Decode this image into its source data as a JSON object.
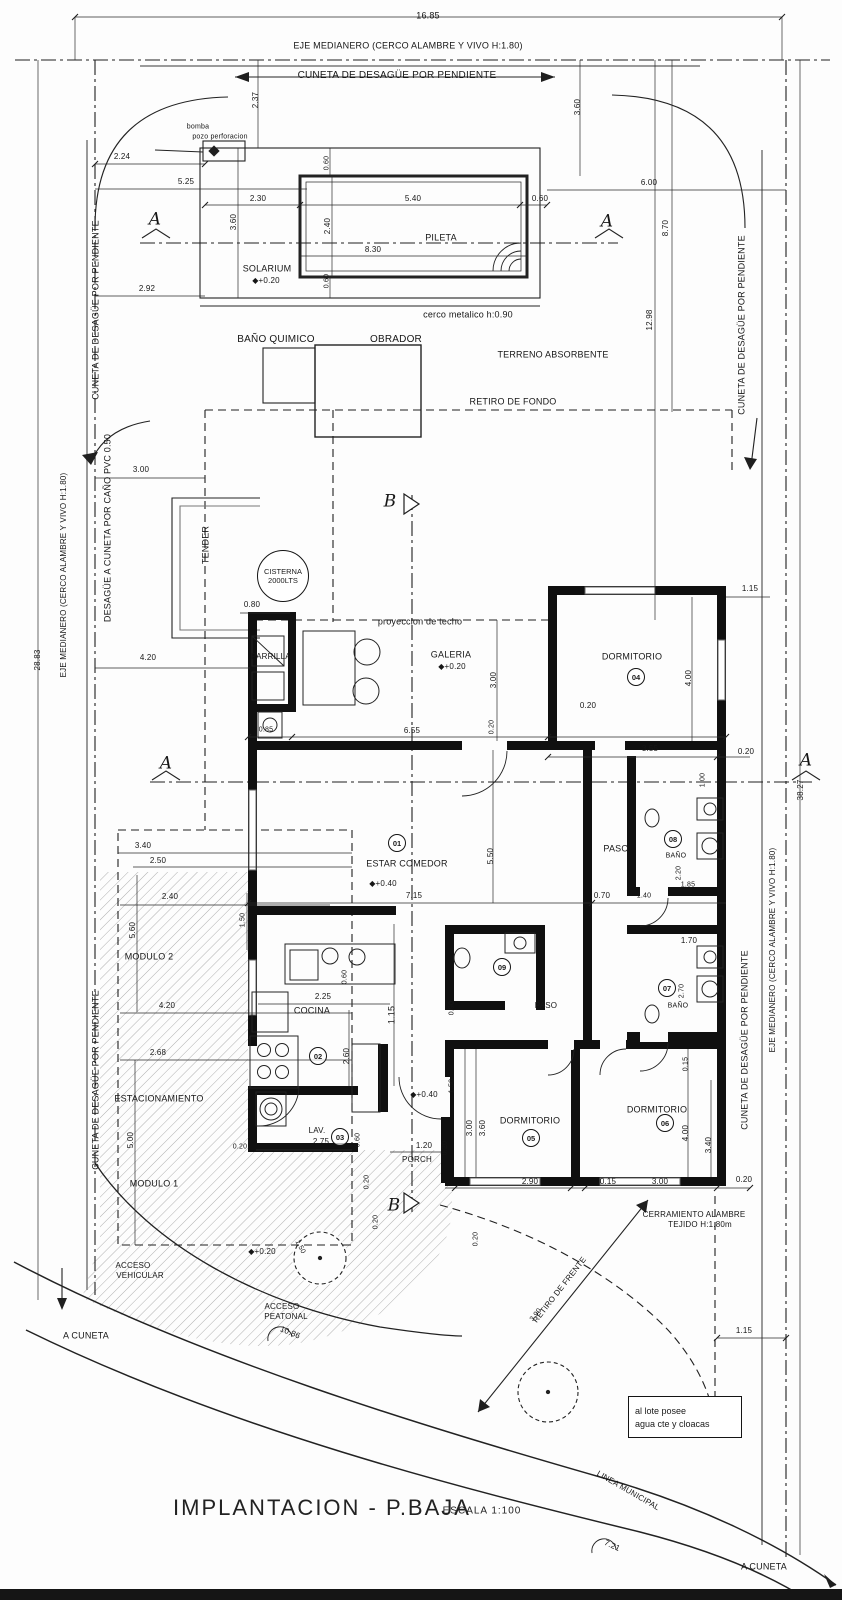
{
  "meta": {
    "title_main": "IMPLANTACION  -  P.BAJA",
    "title_scale": "ESCALA 1:100",
    "ink": "#1a1a1a",
    "wall": "#101010",
    "gray": "#9a9a9a"
  },
  "cisterna": {
    "l1": "CISTERNA",
    "l2": "2000LTS"
  },
  "note_box": {
    "l1": "al lote posee",
    "l2": "agua cte y cloacas"
  },
  "room_numbers": [
    {
      "n": "01",
      "x": 397,
      "y": 843
    },
    {
      "n": "02",
      "x": 318,
      "y": 1056
    },
    {
      "n": "03",
      "x": 340,
      "y": 1137
    },
    {
      "n": "04",
      "x": 636,
      "y": 677
    },
    {
      "n": "05",
      "x": 531,
      "y": 1138
    },
    {
      "n": "06",
      "x": 665,
      "y": 1123
    },
    {
      "n": "07",
      "x": 667,
      "y": 988
    },
    {
      "n": "08",
      "x": 673,
      "y": 839
    },
    {
      "n": "09",
      "x": 502,
      "y": 967
    }
  ],
  "labels": [
    {
      "t": "16.85",
      "x": 428,
      "y": 16,
      "r": 0,
      "s": 9
    },
    {
      "t": "EJE MEDIANERO (CERCO ALAMBRE Y VIVO H:1.80)",
      "x": 408,
      "y": 46,
      "r": 0,
      "s": 9
    },
    {
      "t": "CUNETA DE DESAGÜE POR PENDIENTE",
      "x": 397,
      "y": 76,
      "r": 0,
      "s": 10
    },
    {
      "t": "2.37",
      "x": 256,
      "y": 100,
      "r": -90,
      "s": 8
    },
    {
      "t": "3.60",
      "x": 578,
      "y": 107,
      "r": -90,
      "s": 8
    },
    {
      "t": "bomba",
      "x": 198,
      "y": 127,
      "r": 0,
      "s": 7
    },
    {
      "t": "pozo perforacion",
      "x": 220,
      "y": 137,
      "r": 0,
      "s": 7
    },
    {
      "t": "2.24",
      "x": 122,
      "y": 157,
      "r": 0,
      "s": 8
    },
    {
      "t": "5.25",
      "x": 186,
      "y": 182,
      "r": 0,
      "s": 8
    },
    {
      "t": "0.60",
      "x": 327,
      "y": 163,
      "r": -90,
      "s": 7
    },
    {
      "t": "2.30",
      "x": 258,
      "y": 199,
      "r": 0,
      "s": 8
    },
    {
      "t": "5.40",
      "x": 413,
      "y": 199,
      "r": 0,
      "s": 8
    },
    {
      "t": "0.60",
      "x": 540,
      "y": 199,
      "r": 0,
      "s": 8
    },
    {
      "t": "3.60",
      "x": 234,
      "y": 222,
      "r": -90,
      "s": 8
    },
    {
      "t": "2.40",
      "x": 328,
      "y": 226,
      "r": -90,
      "s": 8
    },
    {
      "t": "A",
      "x": 155,
      "y": 220,
      "r": 0,
      "s": 17,
      "i": 1
    },
    {
      "t": "A",
      "x": 607,
      "y": 222,
      "r": 0,
      "s": 17,
      "i": 1
    },
    {
      "t": "PILETA",
      "x": 441,
      "y": 238,
      "r": 0,
      "s": 9
    },
    {
      "t": "8.30",
      "x": 373,
      "y": 250,
      "r": 0,
      "s": 8
    },
    {
      "t": "SOLARIUM",
      "x": 267,
      "y": 269,
      "r": 0,
      "s": 9
    },
    {
      "t": "◆+0.20",
      "x": 266,
      "y": 281,
      "r": 0,
      "s": 8
    },
    {
      "t": "2.92",
      "x": 147,
      "y": 289,
      "r": 0,
      "s": 8
    },
    {
      "t": "0.60",
      "x": 327,
      "y": 281,
      "r": -90,
      "s": 7
    },
    {
      "t": "6.00",
      "x": 649,
      "y": 183,
      "r": 0,
      "s": 8
    },
    {
      "t": "8.70",
      "x": 666,
      "y": 228,
      "r": -90,
      "s": 8
    },
    {
      "t": "12.98",
      "x": 650,
      "y": 320,
      "r": -90,
      "s": 8
    },
    {
      "t": "cerco metalico h:0.90",
      "x": 468,
      "y": 315,
      "r": 0,
      "s": 9
    },
    {
      "t": "BAÑO QUIMICO",
      "x": 276,
      "y": 340,
      "r": 0,
      "s": 10
    },
    {
      "t": "OBRADOR",
      "x": 396,
      "y": 340,
      "r": 0,
      "s": 10
    },
    {
      "t": "TERRENO ABSORBENTE",
      "x": 553,
      "y": 355,
      "r": 0,
      "s": 9
    },
    {
      "t": "RETIRO DE FONDO",
      "x": 513,
      "y": 402,
      "r": 0,
      "s": 9
    },
    {
      "t": "CUNETA DE DESAGÜE POR PENDIENTE",
      "x": 742,
      "y": 325,
      "r": -90,
      "s": 9
    },
    {
      "t": "CUNETA DE DESAGÜE POR PENDIENTE",
      "x": 96,
      "y": 310,
      "r": -90,
      "s": 9
    },
    {
      "t": "3.00",
      "x": 141,
      "y": 470,
      "r": 0,
      "s": 8
    },
    {
      "t": "DESAGÜE A CUNETA POR CAÑO PVC 0.50",
      "x": 108,
      "y": 528,
      "r": -90,
      "s": 9
    },
    {
      "t": "EJE MEDIANERO (CERCO ALAMBRE Y VIVO H:1.80)",
      "x": 64,
      "y": 575,
      "r": -90,
      "s": 8
    },
    {
      "t": "28.83",
      "x": 38,
      "y": 660,
      "r": -90,
      "s": 8
    },
    {
      "t": "TENDER",
      "x": 206,
      "y": 545,
      "r": -90,
      "s": 9
    },
    {
      "t": "B",
      "x": 390,
      "y": 502,
      "r": 0,
      "s": 17,
      "i": 1
    },
    {
      "t": "0.80",
      "x": 252,
      "y": 605,
      "r": 0,
      "s": 8
    },
    {
      "t": "proyeccion de techo",
      "x": 420,
      "y": 622,
      "r": 0,
      "s": 9
    },
    {
      "t": "PARRILLA",
      "x": 271,
      "y": 657,
      "r": 0,
      "s": 8
    },
    {
      "t": "GALERIA",
      "x": 451,
      "y": 655,
      "r": 0,
      "s": 9
    },
    {
      "t": "◆+0.20",
      "x": 452,
      "y": 667,
      "r": 0,
      "s": 8
    },
    {
      "t": "3.00",
      "x": 494,
      "y": 680,
      "r": -90,
      "s": 8
    },
    {
      "t": "4.20",
      "x": 148,
      "y": 658,
      "r": 0,
      "s": 8
    },
    {
      "t": "DORMITORIO",
      "x": 632,
      "y": 657,
      "r": 0,
      "s": 9
    },
    {
      "t": "1.15",
      "x": 750,
      "y": 589,
      "r": 0,
      "s": 8
    },
    {
      "t": "4.00",
      "x": 689,
      "y": 678,
      "r": -90,
      "s": 8
    },
    {
      "t": "0.20",
      "x": 588,
      "y": 706,
      "r": 0,
      "s": 8
    },
    {
      "t": "0.85",
      "x": 266,
      "y": 730,
      "r": 0,
      "s": 7
    },
    {
      "t": "6.55",
      "x": 412,
      "y": 731,
      "r": 0,
      "s": 8
    },
    {
      "t": "0.20",
      "x": 492,
      "y": 727,
      "r": -90,
      "s": 7
    },
    {
      "t": "3.55",
      "x": 650,
      "y": 749,
      "r": 0,
      "s": 8
    },
    {
      "t": "0.20",
      "x": 746,
      "y": 752,
      "r": 0,
      "s": 8
    },
    {
      "t": "A",
      "x": 166,
      "y": 764,
      "r": 0,
      "s": 17,
      "i": 1
    },
    {
      "t": "A",
      "x": 806,
      "y": 761,
      "r": 0,
      "s": 17,
      "i": 1
    },
    {
      "t": "38.27",
      "x": 801,
      "y": 790,
      "r": -90,
      "s": 8
    },
    {
      "t": "3.40",
      "x": 143,
      "y": 846,
      "r": 0,
      "s": 8
    },
    {
      "t": "2.50",
      "x": 158,
      "y": 861,
      "r": 0,
      "s": 8
    },
    {
      "t": "2.40",
      "x": 170,
      "y": 897,
      "r": 0,
      "s": 8
    },
    {
      "t": "5.60",
      "x": 133,
      "y": 930,
      "r": -90,
      "s": 8
    },
    {
      "t": "1.50",
      "x": 243,
      "y": 920,
      "r": -90,
      "s": 7
    },
    {
      "t": "MODULO 2",
      "x": 149,
      "y": 957,
      "r": 0,
      "s": 9
    },
    {
      "t": "ESTAR COMEDOR",
      "x": 407,
      "y": 864,
      "r": 0,
      "s": 9
    },
    {
      "t": "◆+0.40",
      "x": 383,
      "y": 884,
      "r": 0,
      "s": 8
    },
    {
      "t": "5.50",
      "x": 491,
      "y": 856,
      "r": -90,
      "s": 8
    },
    {
      "t": "7.15",
      "x": 414,
      "y": 896,
      "r": 0,
      "s": 8
    },
    {
      "t": "PASO",
      "x": 616,
      "y": 849,
      "r": 0,
      "s": 9
    },
    {
      "t": "0.70",
      "x": 602,
      "y": 896,
      "r": 0,
      "s": 8
    },
    {
      "t": "1.40",
      "x": 644,
      "y": 896,
      "r": 0,
      "s": 7
    },
    {
      "t": "BAÑO",
      "x": 676,
      "y": 856,
      "r": 0,
      "s": 7
    },
    {
      "t": "2.20",
      "x": 679,
      "y": 873,
      "r": -90,
      "s": 7
    },
    {
      "t": "1.00",
      "x": 703,
      "y": 780,
      "r": -90,
      "s": 7
    },
    {
      "t": "1.85",
      "x": 688,
      "y": 885,
      "r": 0,
      "s": 7
    },
    {
      "t": "1.70",
      "x": 689,
      "y": 941,
      "r": 0,
      "s": 8
    },
    {
      "t": "2.70",
      "x": 682,
      "y": 991,
      "r": -90,
      "s": 7
    },
    {
      "t": "BAÑO",
      "x": 678,
      "y": 1006,
      "r": 0,
      "s": 7
    },
    {
      "t": "0.90",
      "x": 452,
      "y": 1008,
      "r": -90,
      "s": 7
    },
    {
      "t": "PASO",
      "x": 546,
      "y": 1006,
      "r": 0,
      "s": 8
    },
    {
      "t": "COCINA",
      "x": 312,
      "y": 1011,
      "r": 0,
      "s": 9
    },
    {
      "t": "2.25",
      "x": 323,
      "y": 997,
      "r": 0,
      "s": 8
    },
    {
      "t": "0.60",
      "x": 345,
      "y": 977,
      "r": -90,
      "s": 7
    },
    {
      "t": "1.15",
      "x": 392,
      "y": 1015,
      "r": -90,
      "s": 9
    },
    {
      "t": "2.60",
      "x": 347,
      "y": 1056,
      "r": -90,
      "s": 8
    },
    {
      "t": "ESTACIONAMIENTO",
      "x": 159,
      "y": 1099,
      "r": 0,
      "s": 9
    },
    {
      "t": "5.00",
      "x": 131,
      "y": 1140,
      "r": -90,
      "s": 8
    },
    {
      "t": "MODULO 1",
      "x": 154,
      "y": 1184,
      "r": 0,
      "s": 9
    },
    {
      "t": "4.20",
      "x": 167,
      "y": 1006,
      "r": 0,
      "s": 8
    },
    {
      "t": "2.68",
      "x": 158,
      "y": 1053,
      "r": 0,
      "s": 8
    },
    {
      "t": "◆+0.40",
      "x": 424,
      "y": 1095,
      "r": 0,
      "s": 8
    },
    {
      "t": "1.50",
      "x": 452,
      "y": 1086,
      "r": -90,
      "s": 7
    },
    {
      "t": "LAV.",
      "x": 317,
      "y": 1131,
      "r": 0,
      "s": 8
    },
    {
      "t": "2.75",
      "x": 321,
      "y": 1142,
      "r": 0,
      "s": 8
    },
    {
      "t": "0.60",
      "x": 358,
      "y": 1140,
      "r": -90,
      "s": 7
    },
    {
      "t": "0.20",
      "x": 240,
      "y": 1147,
      "r": 0,
      "s": 7
    },
    {
      "t": "1.20",
      "x": 424,
      "y": 1146,
      "r": 0,
      "s": 8
    },
    {
      "t": "PORCH",
      "x": 417,
      "y": 1160,
      "r": 0,
      "s": 8
    },
    {
      "t": "0.20",
      "x": 445,
      "y": 1148,
      "r": -90,
      "s": 7
    },
    {
      "t": "0.20",
      "x": 367,
      "y": 1182,
      "r": -90,
      "s": 7
    },
    {
      "t": "DORMITORIO",
      "x": 530,
      "y": 1121,
      "r": 0,
      "s": 9
    },
    {
      "t": "3.60",
      "x": 483,
      "y": 1128,
      "r": -90,
      "s": 8
    },
    {
      "t": "3.00",
      "x": 470,
      "y": 1128,
      "r": -90,
      "s": 8
    },
    {
      "t": "DORMITORIO",
      "x": 657,
      "y": 1110,
      "r": 0,
      "s": 9
    },
    {
      "t": "4.00",
      "x": 686,
      "y": 1133,
      "r": -90,
      "s": 8
    },
    {
      "t": "3.40",
      "x": 709,
      "y": 1145,
      "r": -90,
      "s": 8
    },
    {
      "t": "0.15",
      "x": 686,
      "y": 1064,
      "r": -90,
      "s": 7
    },
    {
      "t": "2.90",
      "x": 530,
      "y": 1182,
      "r": 0,
      "s": 8
    },
    {
      "t": "0.15",
      "x": 608,
      "y": 1182,
      "r": 0,
      "s": 8
    },
    {
      "t": "3.00",
      "x": 660,
      "y": 1182,
      "r": 0,
      "s": 8
    },
    {
      "t": "0.20",
      "x": 744,
      "y": 1180,
      "r": 0,
      "s": 8
    },
    {
      "t": "0.20",
      "x": 376,
      "y": 1222,
      "r": -90,
      "s": 7
    },
    {
      "t": "0.20",
      "x": 476,
      "y": 1239,
      "r": -90,
      "s": 7
    },
    {
      "t": "CERRAMIENTO ALAMBRE",
      "x": 694,
      "y": 1215,
      "r": 0,
      "s": 8
    },
    {
      "t": "TEJIDO H:1.80m",
      "x": 700,
      "y": 1225,
      "r": 0,
      "s": 8
    },
    {
      "t": "B",
      "x": 394,
      "y": 1206,
      "r": 0,
      "s": 17,
      "i": 1
    },
    {
      "t": "◆+0.20",
      "x": 262,
      "y": 1252,
      "r": 0,
      "s": 8
    },
    {
      "t": "ACCESO",
      "x": 133,
      "y": 1266,
      "r": 0,
      "s": 8
    },
    {
      "t": "VEHICULAR",
      "x": 140,
      "y": 1276,
      "r": 0,
      "s": 8
    },
    {
      "t": "1.50",
      "x": 300,
      "y": 1247,
      "r": 62,
      "s": 7
    },
    {
      "t": "ACCESO",
      "x": 282,
      "y": 1307,
      "r": 0,
      "s": 8
    },
    {
      "t": "PEATONAL",
      "x": 286,
      "y": 1317,
      "r": 0,
      "s": 8
    },
    {
      "t": "RETIRO DE FRENTE",
      "x": 560,
      "y": 1290,
      "r": -52,
      "s": 8
    },
    {
      "t": "3.90",
      "x": 536,
      "y": 1315,
      "r": -52,
      "s": 7
    },
    {
      "t": "1.15",
      "x": 744,
      "y": 1331,
      "r": 0,
      "s": 8
    },
    {
      "t": "10.86",
      "x": 290,
      "y": 1333,
      "r": 22,
      "s": 8
    },
    {
      "t": "LINEA MUNICIPAL",
      "x": 628,
      "y": 1491,
      "r": 30,
      "s": 8
    },
    {
      "t": "7.21",
      "x": 612,
      "y": 1546,
      "r": 25,
      "s": 8
    },
    {
      "t": "A CUNETA",
      "x": 764,
      "y": 1567,
      "r": 0,
      "s": 9
    },
    {
      "t": "A CUNETA",
      "x": 86,
      "y": 1336,
      "r": 0,
      "s": 9
    },
    {
      "t": "EJE MEDIANERO (CERCO ALAMBRE Y VIVO H:1.80)",
      "x": 773,
      "y": 950,
      "r": -90,
      "s": 8
    },
    {
      "t": "CUNETA DE DESAGÜE POR PENDIENTE",
      "x": 745,
      "y": 1040,
      "r": -90,
      "s": 9
    },
    {
      "t": "CUNETA DE DESAGÜE POR PENDIENTE",
      "x": 96,
      "y": 1080,
      "r": -90,
      "s": 9
    }
  ]
}
